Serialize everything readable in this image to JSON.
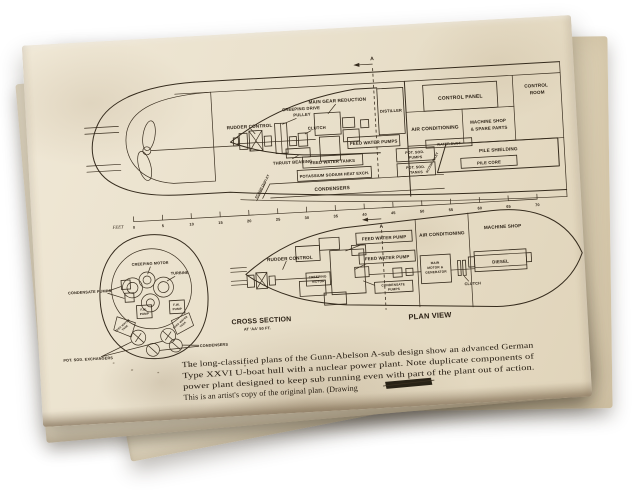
{
  "paper": {
    "background_color": "#ffffff",
    "sheet_color": "#e9e0cb",
    "ink_color": "#352b1d"
  },
  "elevation": {
    "labels": {
      "rudder_control": "RUDDER CONTROL",
      "creeping_drive": [
        "CREEPING DRIVE",
        "PULLEY"
      ],
      "clutch": "CLUTCH",
      "thrust_bearing": "THRUST BEARING",
      "main_gear_reduction": "MAIN GEAR REDUCTION",
      "feed_water_pumps": "FEED WATER PUMPS",
      "distiller": "DISTILLER",
      "control_panel": "CONTROL PANEL",
      "control_room": [
        "CONTROL",
        "ROOM"
      ],
      "air_conditioning": "AIR CONDITIONING",
      "machine_shop": [
        "MACHINE SHOP",
        "& SPARE PARTS"
      ],
      "water_duct": "WATER DUCT",
      "feed_water_tanks": "FEED WATER TANKS",
      "potassium_sodium": "POTASSIUM SODIUM HEAT EXCH.",
      "condensers": "CONDENSERS",
      "pot_sod_pumps": [
        "POT. SOD.",
        "PUMPS"
      ],
      "pot_sod_tanks": [
        "POT. SOD.",
        "TANKS"
      ],
      "pile_shielding": "PILE SHIELDING",
      "pile_core": "PILE CORE",
      "scoop_outlet": "SCOOP OUTLET",
      "scoop_inlet": "SCOOP INLET",
      "section_marker": "A"
    }
  },
  "scale": {
    "unit_label": "FEET",
    "ticks": [
      "0",
      "5",
      "10",
      "15",
      "20",
      "25",
      "30",
      "35",
      "40",
      "45",
      "50",
      "55",
      "60",
      "65",
      "70"
    ],
    "section_marker": "A"
  },
  "cross_section": {
    "title": "CROSS SECTION",
    "subtitle": "AT 'AA' 50 FT.",
    "labels": {
      "creeping_motor": "CREEPING MOTOR",
      "turbine": "TURBINE",
      "condensate_pumps": "CONDENSATE PUMPS",
      "fw_pump": [
        "F.W.",
        "PUMP"
      ],
      "feed_water_tank": [
        "FEED WATER",
        "TANK"
      ],
      "pot_sod_exchangers": "POT. SOD. EXCHANGERS",
      "condensers": "CONDENSERS"
    }
  },
  "plan": {
    "title": "PLAN VIEW",
    "labels": {
      "rudder_control": "RUDDER CONTROL",
      "creeping_motor": [
        "CREEPING",
        "MOTOR"
      ],
      "feed_water_pump": "FEED WATER PUMP",
      "condensate_pumps": [
        "CONDENSATE",
        "PUMPS"
      ],
      "main_motor_generator": [
        "MAIN",
        "MOTOR &",
        "GENERATOR"
      ],
      "clutch": "CLUTCH",
      "diesel": "DIESEL",
      "air_conditioning": "AIR CONDITIONING",
      "machine_shop": "MACHINE SHOP"
    }
  },
  "caption": {
    "line1": "The long-classified plans of the Gunn-Abelson A-sub design show an advanced German",
    "line2": "Type XXVI U-boat hull with a nuclear power plant. Note duplicate components of",
    "line3": "power plant designed to keep sub running even with part of the plant out of action.",
    "line4": "This is an artist's copy of the original plan. (Drawing"
  }
}
